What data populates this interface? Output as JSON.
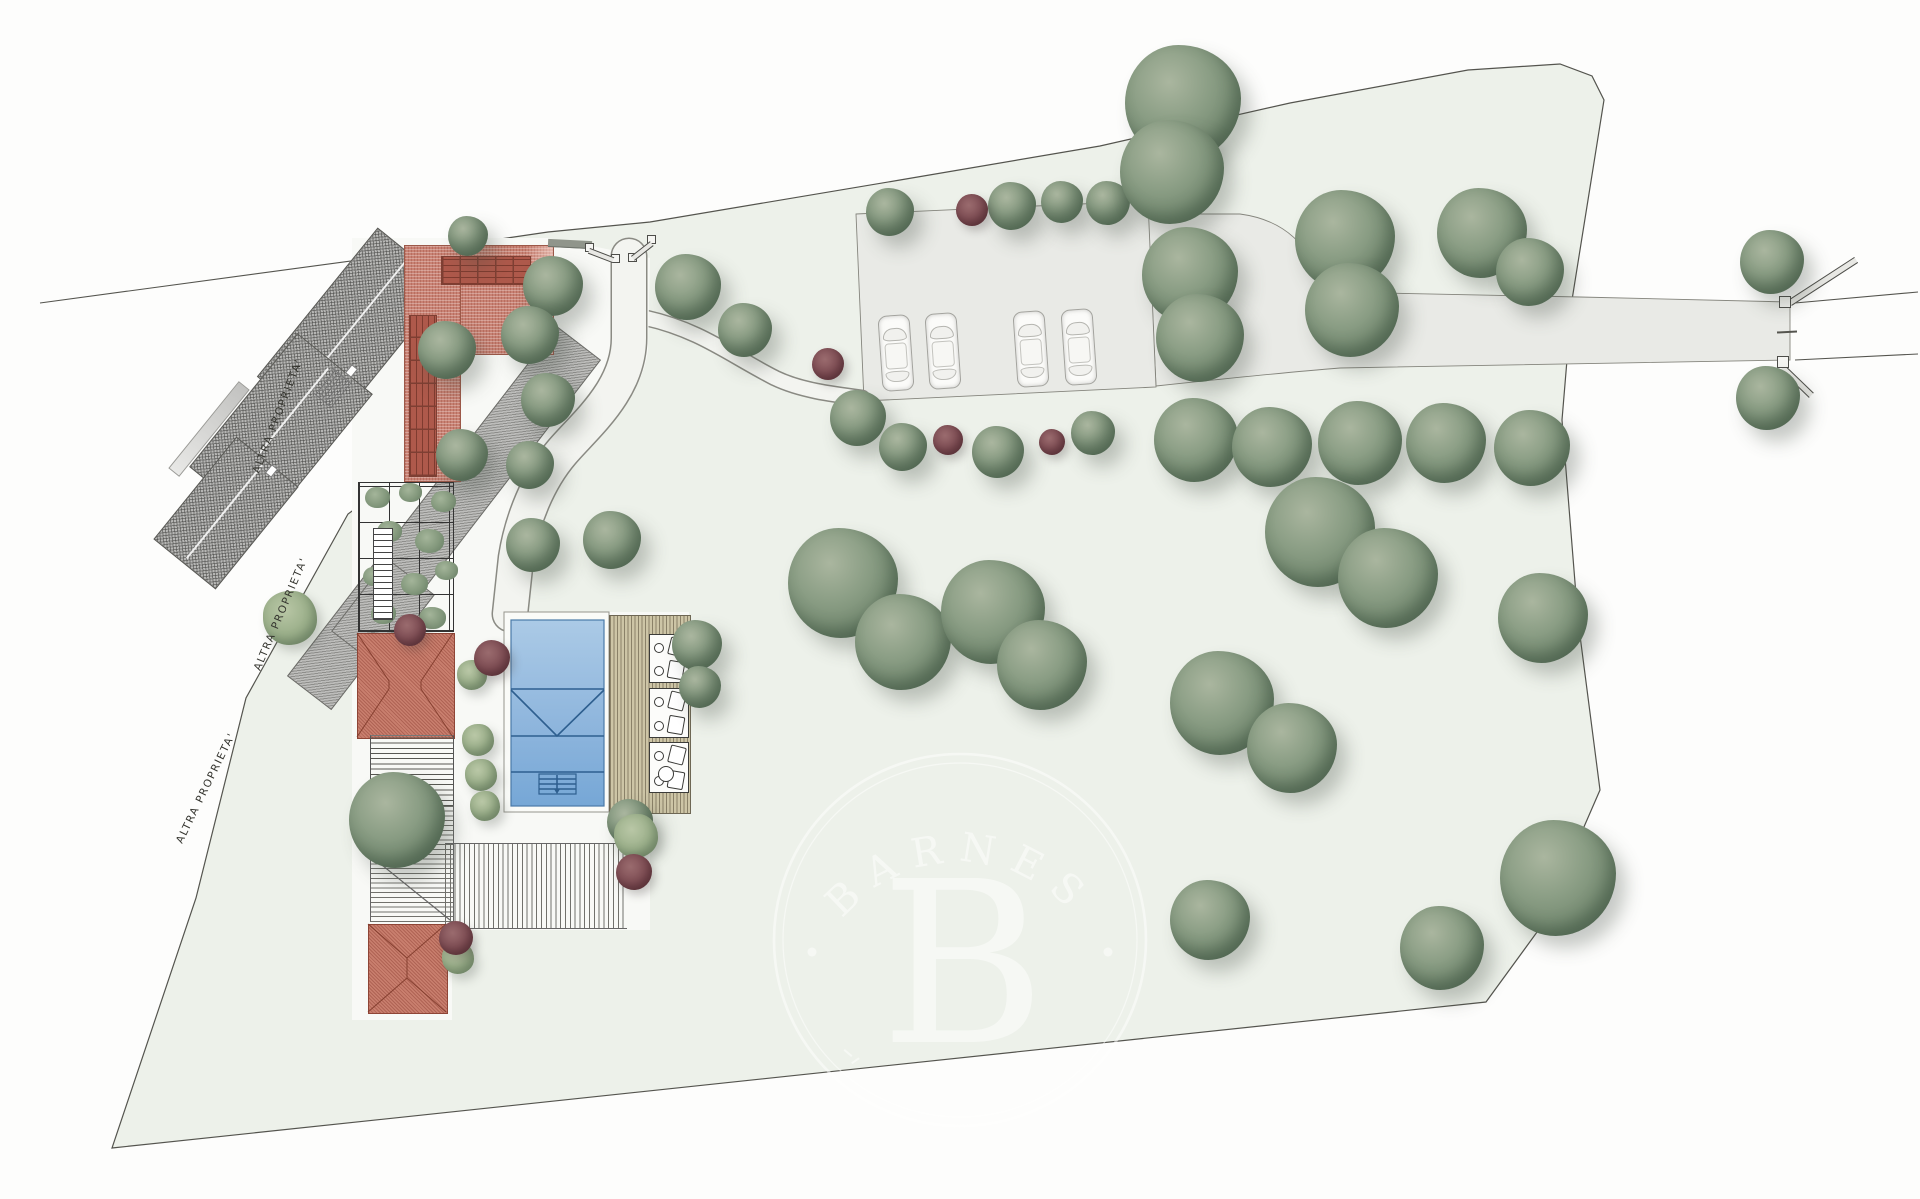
{
  "labels": {
    "altra_proprieta": "ALTRA PROPRIETA'"
  },
  "watermark": {
    "brand": "BARNES",
    "initial": "B"
  },
  "colors": {
    "terrain": "#edf1ea",
    "road": "#e9eae6",
    "courtyard": "#f8f9f6",
    "boundary": "#54544e",
    "roof_red": "#c98274",
    "roof_red_dark": "#8e4536",
    "panel": "#ae594b",
    "gray_roof": "#b6b6b4",
    "pool_light": "#abcae6",
    "pool_dark": "#76a7d6",
    "pool_line": "#2e5f8f",
    "deck": "#cdc5a6",
    "deck_line": "#8a8168",
    "tree_light": "#aab69f",
    "tree_mid": "#8b9e85",
    "tree_dark": "#5e7561",
    "bush_light": "#b9c7a6",
    "purple": "#7c4b52",
    "watermark": "#ffffff"
  },
  "site": {
    "trees": [
      [
        468,
        236,
        20,
        "tree"
      ],
      [
        553,
        286,
        30,
        "tree"
      ],
      [
        688,
        287,
        33,
        "tree"
      ],
      [
        745,
        330,
        27,
        "tree"
      ],
      [
        447,
        350,
        29,
        "tree"
      ],
      [
        530,
        335,
        29,
        "tree"
      ],
      [
        548,
        400,
        27,
        "tree"
      ],
      [
        462,
        455,
        26,
        "tree"
      ],
      [
        530,
        465,
        24,
        "tree"
      ],
      [
        533,
        545,
        27,
        "tree"
      ],
      [
        612,
        540,
        29,
        "tree"
      ],
      [
        697,
        645,
        25,
        "tree"
      ],
      [
        700,
        687,
        21,
        "tree"
      ],
      [
        630,
        822,
        23,
        "tree"
      ],
      [
        397,
        820,
        48,
        "tree"
      ],
      [
        290,
        618,
        27,
        "bush"
      ],
      [
        890,
        212,
        24,
        "tree"
      ],
      [
        1012,
        206,
        24,
        "tree"
      ],
      [
        1062,
        202,
        21,
        "tree"
      ],
      [
        1108,
        203,
        22,
        "tree"
      ],
      [
        858,
        418,
        28,
        "tree"
      ],
      [
        903,
        447,
        24,
        "tree"
      ],
      [
        998,
        452,
        26,
        "tree"
      ],
      [
        1093,
        433,
        22,
        "tree"
      ],
      [
        1183,
        103,
        58,
        "tree"
      ],
      [
        1172,
        172,
        52,
        "tree"
      ],
      [
        1190,
        275,
        48,
        "tree"
      ],
      [
        1200,
        338,
        44,
        "tree"
      ],
      [
        1345,
        240,
        50,
        "tree"
      ],
      [
        1352,
        310,
        47,
        "tree"
      ],
      [
        1482,
        233,
        45,
        "tree"
      ],
      [
        1530,
        272,
        34,
        "tree"
      ],
      [
        1772,
        262,
        32,
        "tree"
      ],
      [
        1768,
        398,
        32,
        "tree"
      ],
      [
        1196,
        440,
        42,
        "tree"
      ],
      [
        1272,
        447,
        40,
        "tree"
      ],
      [
        1360,
        443,
        42,
        "tree"
      ],
      [
        1446,
        443,
        40,
        "tree"
      ],
      [
        1532,
        448,
        38,
        "tree"
      ],
      [
        843,
        583,
        55,
        "tree"
      ],
      [
        903,
        642,
        48,
        "tree"
      ],
      [
        993,
        612,
        52,
        "tree"
      ],
      [
        1042,
        665,
        45,
        "tree"
      ],
      [
        1320,
        532,
        55,
        "tree"
      ],
      [
        1388,
        578,
        50,
        "tree"
      ],
      [
        1543,
        618,
        45,
        "tree"
      ],
      [
        1222,
        703,
        52,
        "tree"
      ],
      [
        1292,
        748,
        45,
        "tree"
      ],
      [
        1558,
        878,
        58,
        "tree"
      ],
      [
        1442,
        948,
        42,
        "tree"
      ],
      [
        1210,
        920,
        40,
        "tree"
      ],
      [
        472,
        675,
        15,
        "bush"
      ],
      [
        478,
        740,
        16,
        "bush"
      ],
      [
        481,
        775,
        16,
        "bush"
      ],
      [
        485,
        806,
        15,
        "bush"
      ],
      [
        458,
        958,
        16,
        "bush"
      ],
      [
        636,
        836,
        22,
        "bush"
      ],
      [
        410,
        630,
        16,
        "purple"
      ],
      [
        492,
        658,
        18,
        "purple"
      ],
      [
        456,
        938,
        17,
        "purple"
      ],
      [
        634,
        872,
        18,
        "purple"
      ],
      [
        828,
        364,
        16,
        "purple"
      ],
      [
        972,
        210,
        16,
        "purple"
      ],
      [
        948,
        440,
        15,
        "purple"
      ],
      [
        1052,
        442,
        13,
        "purple"
      ]
    ],
    "cars": [
      [
        895,
        352
      ],
      [
        942,
        350
      ],
      [
        1030,
        348
      ],
      [
        1078,
        346
      ]
    ],
    "lounger_groups": [
      [
        649,
        634,
        38,
        47
      ],
      [
        649,
        688,
        38,
        48
      ],
      [
        649,
        742,
        38,
        49
      ]
    ],
    "vines": [
      [
        6,
        4,
        13
      ],
      [
        40,
        0,
        12
      ],
      [
        72,
        8,
        13
      ],
      [
        18,
        38,
        13
      ],
      [
        56,
        46,
        15
      ],
      [
        4,
        84,
        12
      ],
      [
        42,
        90,
        14
      ],
      [
        76,
        78,
        12
      ],
      [
        12,
        120,
        13
      ],
      [
        60,
        124,
        14
      ]
    ]
  }
}
